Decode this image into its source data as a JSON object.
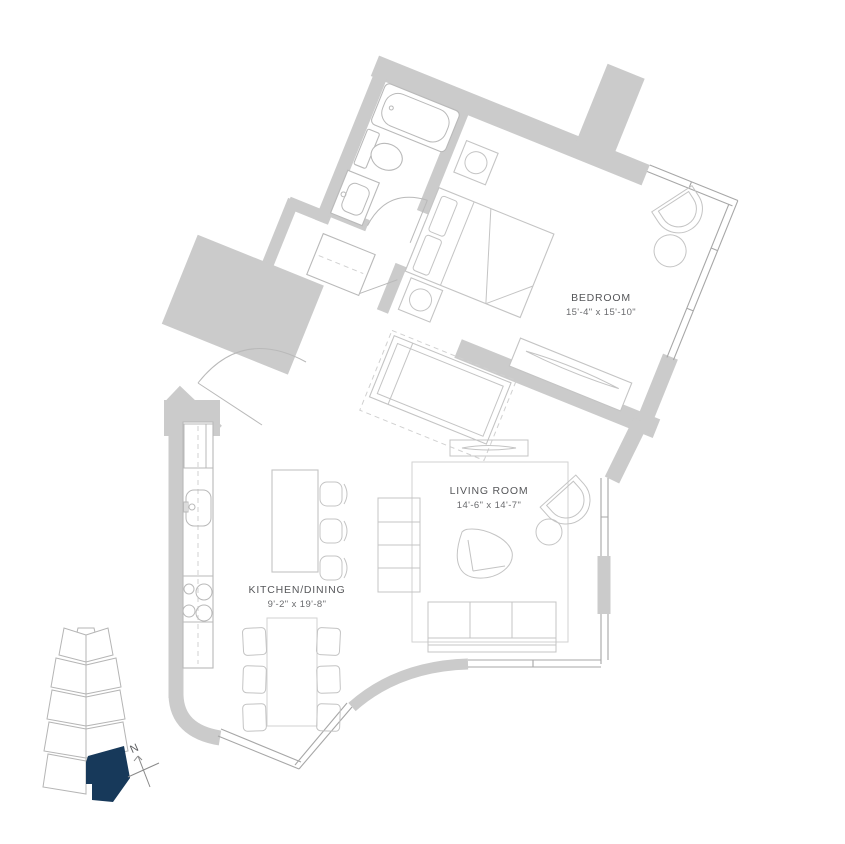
{
  "floorplan": {
    "rooms": {
      "bedroom": {
        "name": "BEDROOM",
        "dims": "15'-4\" x 15'-10\""
      },
      "living_room": {
        "name": "LIVING ROOM",
        "dims": "14'-6\" x 14'-7\""
      },
      "kitchen_dining": {
        "name": "KITCHEN/DINING",
        "dims": "9'-2\" x 19'-8\""
      }
    },
    "compass": {
      "north_label": "N"
    },
    "colors": {
      "wall": "#cbcbcb",
      "window_line": "#a7a7a7",
      "furniture_line": "#c4c4c4",
      "label_text": "#56575a",
      "unit_highlight": "#17395a",
      "background": "#ffffff"
    }
  }
}
